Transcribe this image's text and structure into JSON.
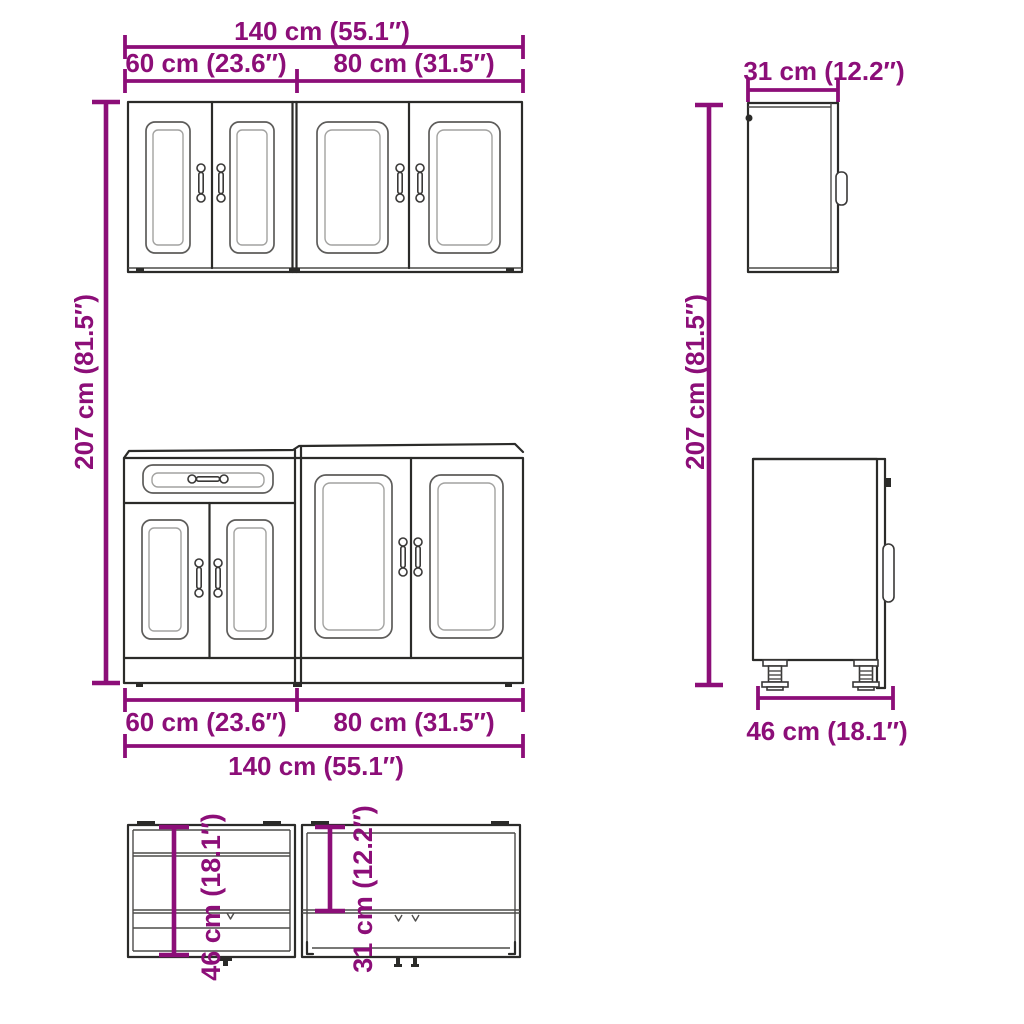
{
  "accent_color": "#8C0E78",
  "line_color": "#2b2b29",
  "labels": {
    "width_total": "140 cm (55.1″)",
    "width_left_unit": "60 cm (23.6″)",
    "width_right_unit": "80 cm (31.5″)",
    "height_total": "207 cm (81.5″)",
    "depth_wall_cabinet": "31 cm (12.2″)",
    "depth_base_cabinet": "46 cm (18.1″)"
  }
}
